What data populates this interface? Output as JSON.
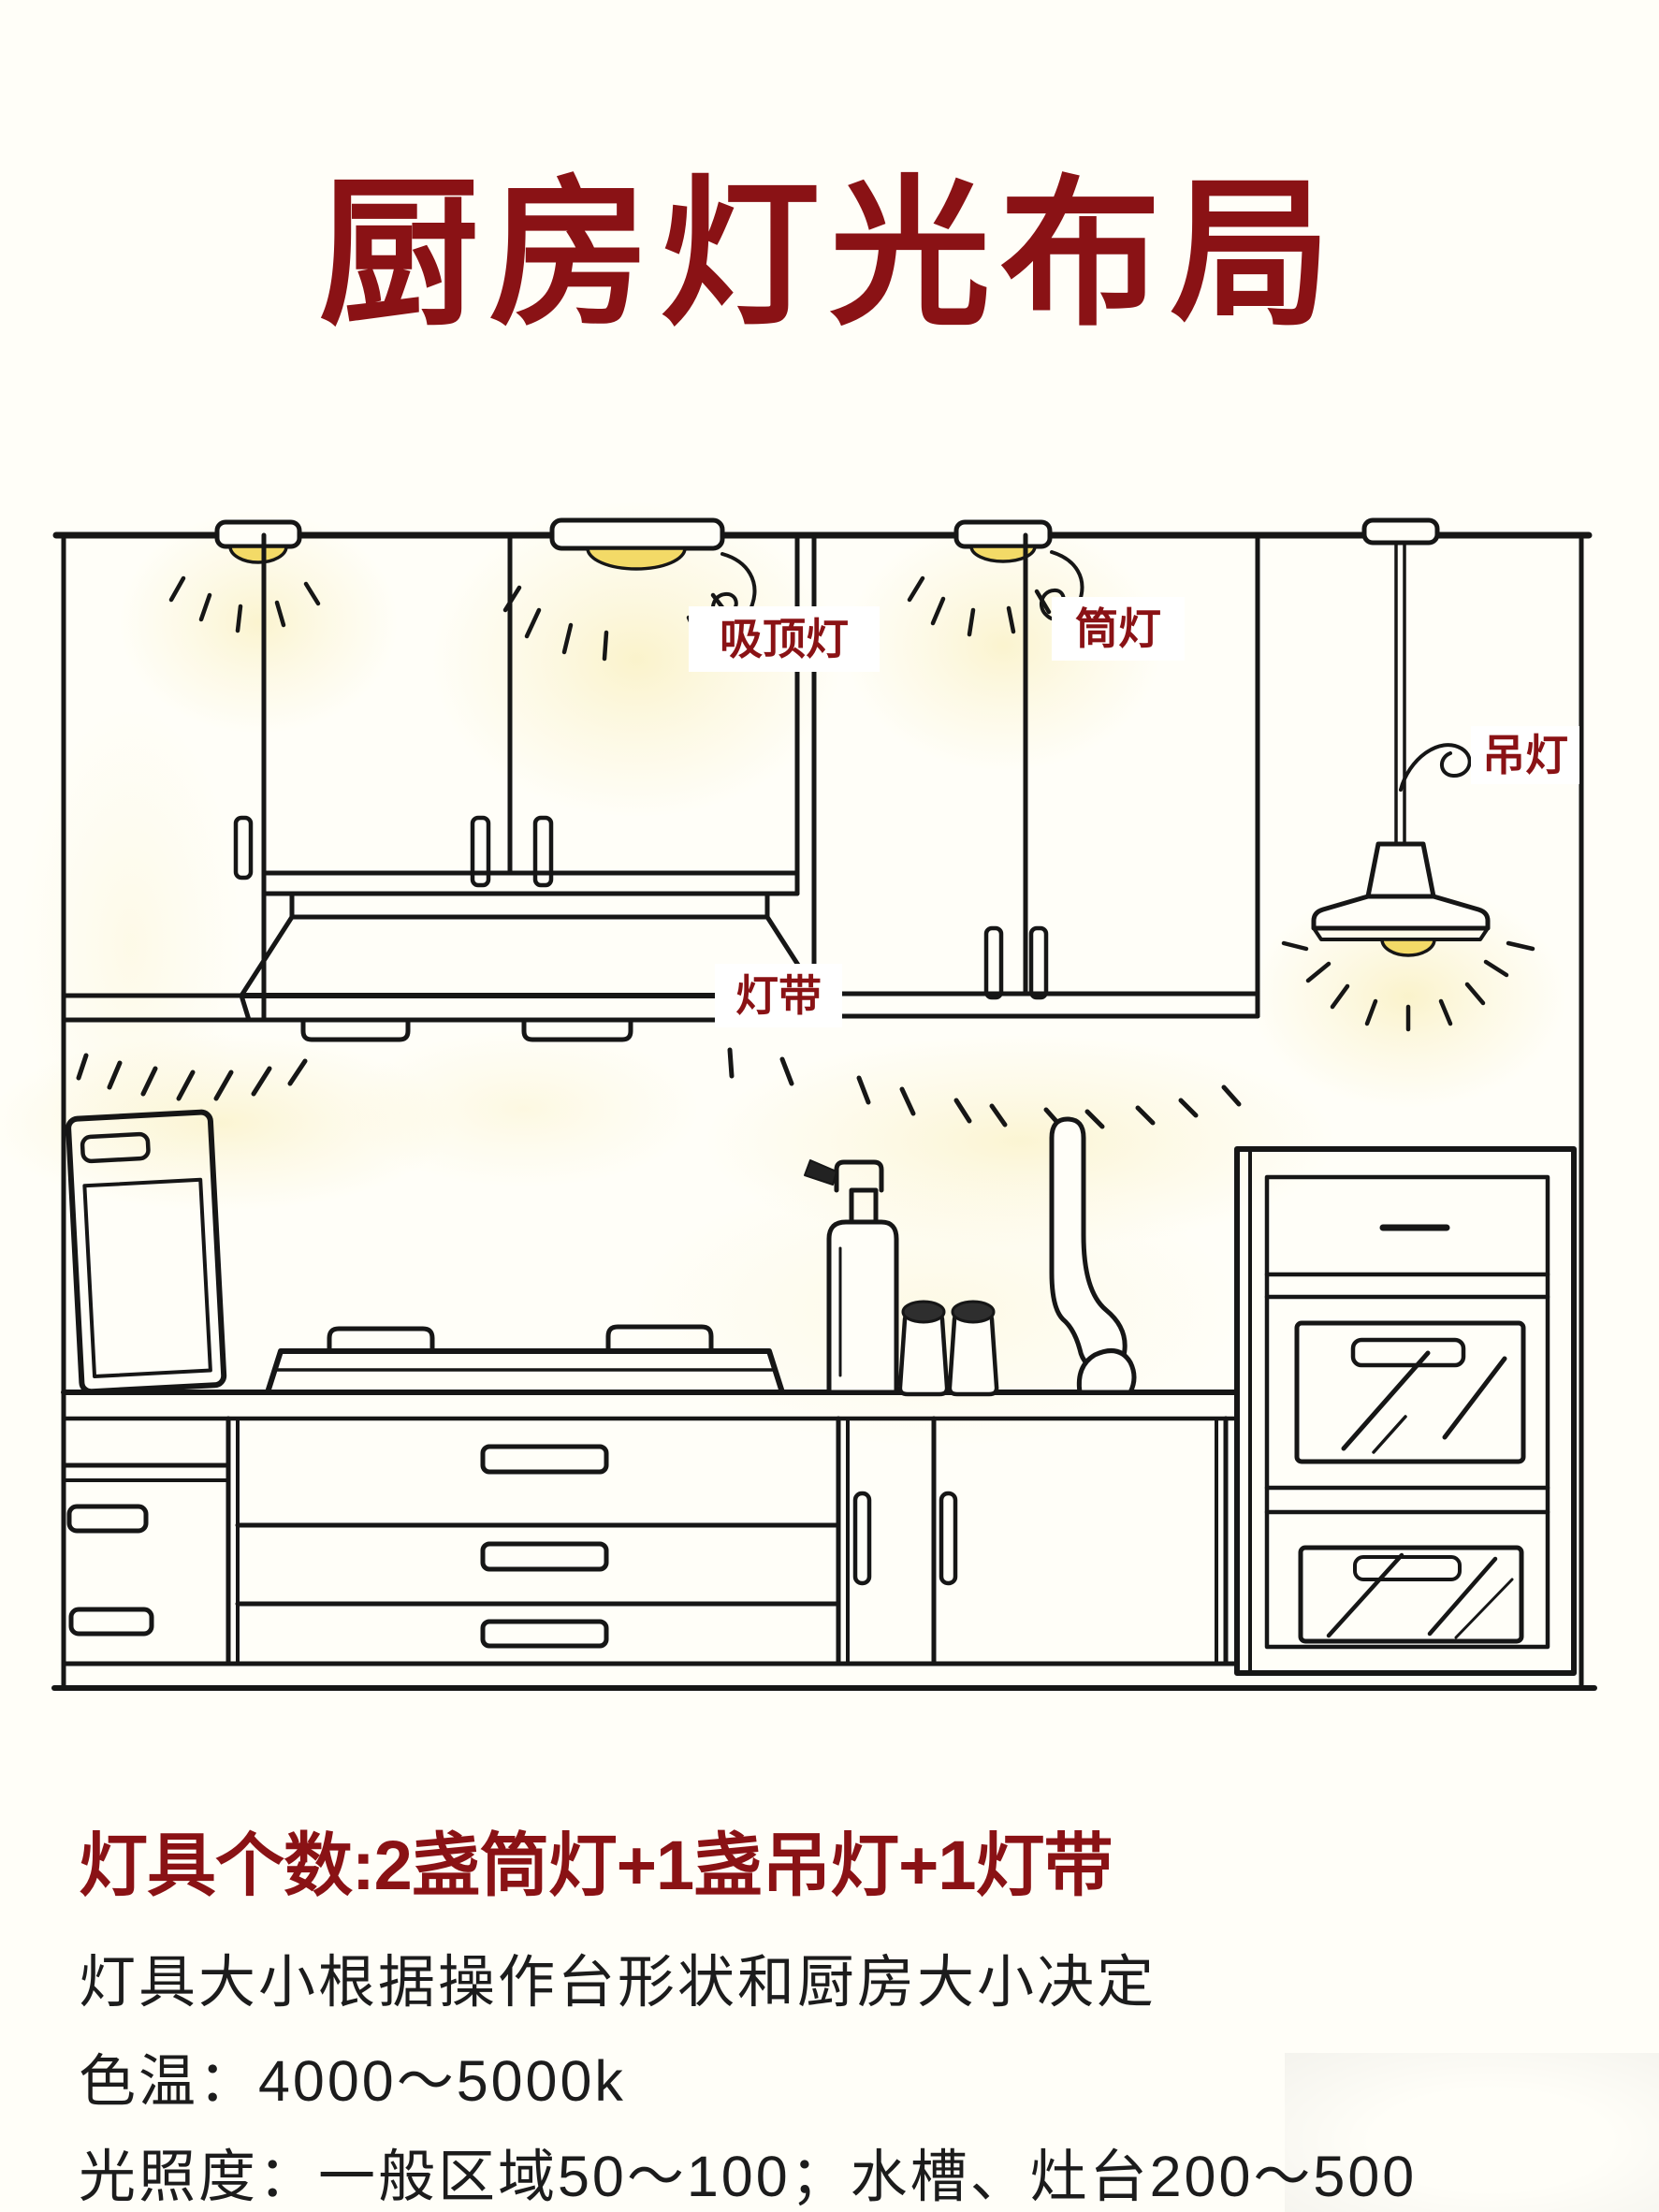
{
  "page": {
    "background": "#FFFEF8"
  },
  "title": {
    "text": "厨房灯光布局",
    "color": "#8A1215"
  },
  "diagram": {
    "label_color": "#8A1215",
    "glow_color": "#F3DA67",
    "line_color": "#161616",
    "labels": {
      "ceiling_light": "吸顶灯",
      "downlight": "筒灯",
      "pendant_light": "吊灯",
      "light_strip": "灯带"
    }
  },
  "notes": {
    "heading": "灯具个数:2盏筒灯+1盏吊灯+1灯带",
    "sizing": "灯具大小根据操作台形状和厨房大小决定",
    "color_temp": "色温：4000～5000k",
    "illuminance": "光照度：一般区域50～100；水槽、灶台200～500"
  }
}
